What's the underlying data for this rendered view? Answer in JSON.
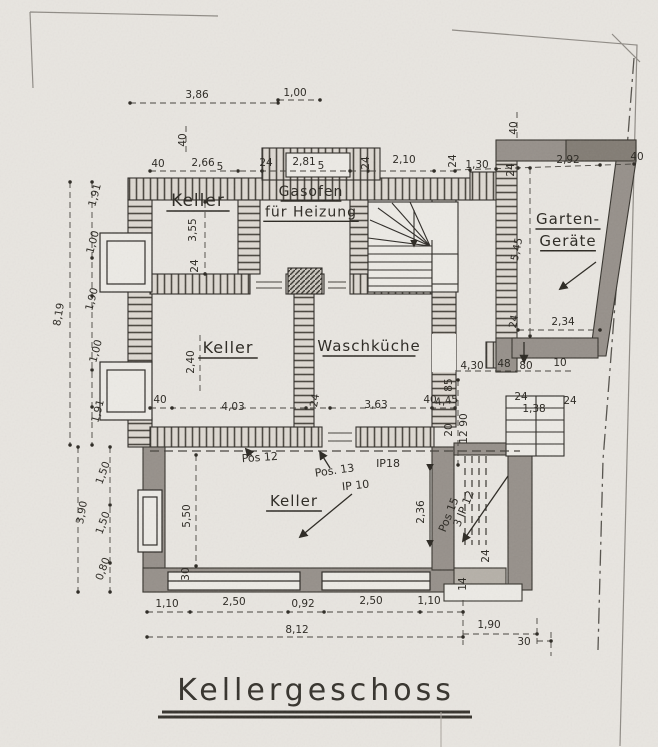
{
  "title": {
    "text": "Kellergeschoss"
  },
  "rooms": [
    {
      "name": "room-keller-top-left",
      "lines": [
        "Keller"
      ],
      "x": 198,
      "y": 206,
      "size": 17
    },
    {
      "name": "room-gasofen-heizung",
      "lines": [
        "Gasofen",
        "für Heizung"
      ],
      "x": 311,
      "y": 196,
      "size": 14
    },
    {
      "name": "room-garten-geraete",
      "lines": [
        "Garten-",
        "Geräte"
      ],
      "x": 568,
      "y": 224,
      "size": 15
    },
    {
      "name": "room-keller-middle",
      "lines": [
        "Keller"
      ],
      "x": 228,
      "y": 353,
      "size": 16
    },
    {
      "name": "room-waschkueche",
      "lines": [
        "Waschküche"
      ],
      "x": 369,
      "y": 351,
      "size": 15
    },
    {
      "name": "room-keller-bottom",
      "lines": [
        "Keller"
      ],
      "x": 294,
      "y": 506,
      "size": 15
    }
  ],
  "annotations": [
    {
      "t": "Pos 12",
      "x": 260,
      "y": 461,
      "r": -4,
      "s": 12
    },
    {
      "t": "Pos. 13",
      "x": 335,
      "y": 474,
      "r": -8,
      "s": 11
    },
    {
      "t": "IP 10",
      "x": 356,
      "y": 489,
      "r": -6,
      "s": 11
    },
    {
      "t": "IP18",
      "x": 388,
      "y": 467,
      "r": 0,
      "s": 12
    },
    {
      "t": "Pos 15",
      "x": 452,
      "y": 516,
      "r": -68,
      "s": 10
    },
    {
      "t": "3 IP 12",
      "x": 467,
      "y": 510,
      "r": -68,
      "s": 10
    }
  ],
  "dimensions": [
    {
      "t": "3,86",
      "x": 197,
      "y": 98,
      "s": 13
    },
    {
      "t": "1,00",
      "x": 295,
      "y": 96,
      "s": 11
    },
    {
      "t": "40",
      "x": 186,
      "y": 140,
      "r": -90,
      "s": 10
    },
    {
      "t": "40",
      "x": 517,
      "y": 128,
      "r": -90,
      "s": 10
    },
    {
      "t": "40",
      "x": 637,
      "y": 160,
      "s": 10
    },
    {
      "t": "40",
      "x": 158,
      "y": 167,
      "s": 10
    },
    {
      "t": "2,66",
      "x": 203,
      "y": 166,
      "s": 12
    },
    {
      "t": "5",
      "x": 220,
      "y": 170,
      "s": 8
    },
    {
      "t": "24",
      "x": 266,
      "y": 166,
      "s": 10
    },
    {
      "t": "2,81",
      "x": 304,
      "y": 165,
      "s": 12
    },
    {
      "t": "5",
      "x": 321,
      "y": 169,
      "s": 8
    },
    {
      "t": "24",
      "x": 369,
      "y": 163,
      "r": -90,
      "s": 10
    },
    {
      "t": "2,10",
      "x": 404,
      "y": 163,
      "s": 12
    },
    {
      "t": "24",
      "x": 456,
      "y": 161,
      "r": -90,
      "s": 10
    },
    {
      "t": "1,30",
      "x": 477,
      "y": 168,
      "s": 11
    },
    {
      "t": "24",
      "x": 514,
      "y": 170,
      "r": -90,
      "s": 10
    },
    {
      "t": "2,92",
      "x": 568,
      "y": 163,
      "s": 12
    },
    {
      "t": "1,91",
      "x": 98,
      "y": 196,
      "r": -75,
      "s": 11
    },
    {
      "t": "1,00",
      "x": 96,
      "y": 243,
      "r": -75,
      "s": 10
    },
    {
      "t": "1,90",
      "x": 95,
      "y": 300,
      "r": -75,
      "s": 11
    },
    {
      "t": "8,19",
      "x": 62,
      "y": 315,
      "r": -80,
      "s": 12
    },
    {
      "t": "1,00",
      "x": 99,
      "y": 352,
      "r": -75,
      "s": 10
    },
    {
      "t": "1,91",
      "x": 101,
      "y": 412,
      "r": -75,
      "s": 11
    },
    {
      "t": "3,55",
      "x": 196,
      "y": 230,
      "r": -90,
      "s": 10
    },
    {
      "t": "24",
      "x": 198,
      "y": 266,
      "r": -90,
      "s": 9
    },
    {
      "t": "2,40",
      "x": 194,
      "y": 362,
      "r": -90,
      "s": 9
    },
    {
      "t": "5,45",
      "x": 520,
      "y": 250,
      "r": -78,
      "s": 11
    },
    {
      "t": "5,50",
      "x": 190,
      "y": 516,
      "r": -90,
      "s": 11
    },
    {
      "t": "2,36",
      "x": 424,
      "y": 512,
      "r": -90,
      "s": 10
    },
    {
      "t": "40",
      "x": 160,
      "y": 403,
      "s": 10
    },
    {
      "t": "4,03",
      "x": 233,
      "y": 410,
      "s": 12
    },
    {
      "t": "24",
      "x": 318,
      "y": 401,
      "r": -80,
      "s": 10
    },
    {
      "t": "3,63",
      "x": 376,
      "y": 408,
      "s": 12
    },
    {
      "t": "40",
      "x": 430,
      "y": 403,
      "s": 10
    },
    {
      "t": "24",
      "x": 517,
      "y": 322,
      "r": -80,
      "s": 10
    },
    {
      "t": "2,34",
      "x": 563,
      "y": 325,
      "s": 12
    },
    {
      "t": "4,30",
      "x": 472,
      "y": 369,
      "s": 8
    },
    {
      "t": "48",
      "x": 504,
      "y": 367,
      "s": 8
    },
    {
      "t": "80",
      "x": 526,
      "y": 369,
      "s": 8
    },
    {
      "t": "10",
      "x": 560,
      "y": 366,
      "s": 8
    },
    {
      "t": "4,45",
      "x": 447,
      "y": 404,
      "r": -8,
      "s": 9
    },
    {
      "t": "85",
      "x": 452,
      "y": 385,
      "r": -90,
      "s": 7
    },
    {
      "t": "20",
      "x": 452,
      "y": 430,
      "r": -90,
      "s": 7
    },
    {
      "t": "90",
      "x": 467,
      "y": 420,
      "r": -90,
      "s": 7
    },
    {
      "t": "12",
      "x": 467,
      "y": 437,
      "r": -90,
      "s": 7
    },
    {
      "t": "24",
      "x": 521,
      "y": 400,
      "s": 8
    },
    {
      "t": "1,38",
      "x": 534,
      "y": 412,
      "s": 8
    },
    {
      "t": "24",
      "x": 570,
      "y": 404,
      "s": 11
    },
    {
      "t": "14",
      "x": 466,
      "y": 584,
      "r": -90,
      "s": 7
    },
    {
      "t": "24",
      "x": 489,
      "y": 556,
      "r": -90,
      "s": 7
    },
    {
      "t": "1,50",
      "x": 106,
      "y": 474,
      "r": -70,
      "s": 10
    },
    {
      "t": "3,90",
      "x": 85,
      "y": 513,
      "r": -80,
      "s": 12
    },
    {
      "t": "1,50",
      "x": 106,
      "y": 524,
      "r": -70,
      "s": 10
    },
    {
      "t": "0,80",
      "x": 106,
      "y": 570,
      "r": -70,
      "s": 10
    },
    {
      "t": "30",
      "x": 189,
      "y": 574,
      "r": -90,
      "s": 9
    },
    {
      "t": "1,10",
      "x": 167,
      "y": 607,
      "s": 11
    },
    {
      "t": "2,50",
      "x": 234,
      "y": 605,
      "s": 12
    },
    {
      "t": "0,92",
      "x": 303,
      "y": 607,
      "s": 11
    },
    {
      "t": "2,50",
      "x": 371,
      "y": 604,
      "s": 12
    },
    {
      "t": "1,10",
      "x": 429,
      "y": 604,
      "s": 11
    },
    {
      "t": "8,12",
      "x": 297,
      "y": 633,
      "s": 13
    },
    {
      "t": "1,90",
      "x": 489,
      "y": 628,
      "s": 12
    },
    {
      "t": "30",
      "x": 524,
      "y": 645,
      "s": 10
    }
  ],
  "colors": {
    "paper": "#e8e5e0",
    "ink": "#2b2822",
    "wall_hatch_bg": "#ddd8d1",
    "wall_gray": "#96908a",
    "wall_dark": "#827c74"
  }
}
